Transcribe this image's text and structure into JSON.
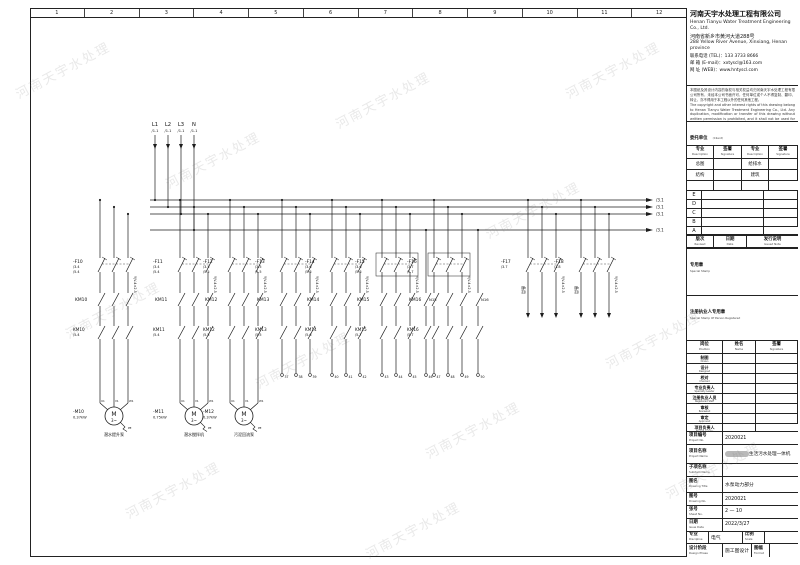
{
  "watermark": "河南天宇水处理",
  "ruler": {
    "numbers": [
      "1",
      "2",
      "3",
      "4",
      "5",
      "6",
      "7",
      "8",
      "9",
      "10",
      "11",
      "12"
    ]
  },
  "title_block": {
    "company": {
      "name_cn": "河南天宇水处理工程有限公司",
      "name_en": "Henan Tianyu Water Treatment Engineering Co., Ltd.",
      "address_cn": "河南省新乡市黄河大道288号",
      "address_en": "288 Yellow River Avenue, Xinxiang, Henan province",
      "tel_line": "联系电话 (TEL)：133 3733 8666",
      "email_line": "邮  箱 (E-mail)：xxtyscl@163.com",
      "web_line": "网  址 (WEB)：www.hntyscl.com"
    },
    "disclaimer_cn": "本图纸及其设计内容的版权与相关权益均归河南天宇水处理工程有限公司所有，未经本公司书面许可，任何单位或个人不得复制、翻印、转让，亦不得用于本工程以外的任何其他工程。",
    "disclaimer_en": "The copyright and other interest rights of this drawing belong to Henan Tianyu Water Treatment Engineering Co., Ltd. Any duplication, modification or transfer of this drawing without written permission is prohibited, and it shall not be used for any other project.",
    "client": {
      "label_cn": "委托单位",
      "label_en": "(Client)",
      "value_suffix": "有限公司"
    },
    "spec_table": {
      "headers": [
        {
          "cn": "专业",
          "en": "Description"
        },
        {
          "cn": "签署",
          "en": "Signature"
        },
        {
          "cn": "专业",
          "en": "Description"
        },
        {
          "cn": "签署",
          "en": "Signature"
        }
      ],
      "rows": [
        [
          "总图",
          "",
          "给排水",
          ""
        ],
        [
          "结构",
          "",
          "建筑",
          ""
        ],
        [
          "",
          "",
          "",
          ""
        ]
      ]
    },
    "revisions": {
      "letters": [
        "E",
        "D",
        "C",
        "B",
        "A"
      ],
      "header": [
        {
          "cn": "版次",
          "en": "Revised"
        },
        {
          "cn": "日期",
          "en": "Date"
        },
        {
          "cn": "发行说明",
          "en": "Issued Note"
        }
      ]
    },
    "stamp1": {
      "cn": "专用章",
      "en": "Special Stamp"
    },
    "stamp2": {
      "cn": "注册执业人专用章",
      "en": "Special Stamp Of Person Registered"
    },
    "personnel": {
      "header": [
        {
          "cn": "岗位",
          "en": "Position"
        },
        {
          "cn": "姓名",
          "en": "Name"
        },
        {
          "cn": "签署",
          "en": "Signature"
        }
      ],
      "rows": [
        {
          "cn": "制图",
          "en": "Drawn"
        },
        {
          "cn": "设计",
          "en": "Designed"
        },
        {
          "cn": "校对",
          "en": "Checked"
        },
        {
          "cn": "专业负责人",
          "en": "Specialty Leader"
        },
        {
          "cn": "注册执业人员",
          "en": "Registered Staff"
        },
        {
          "cn": "审核",
          "en": "Reviewed"
        },
        {
          "cn": "审定",
          "en": "Approved"
        },
        {
          "cn": "项目负责人",
          "en": "Project Leader"
        }
      ]
    },
    "project_no": {
      "label_cn": "项目编号",
      "label_en": "Project No.",
      "value": "2020021"
    },
    "project_name": {
      "label_cn": "项目名称",
      "label_en": "Project Name",
      "value_suffix": "生活污水处理一体机"
    },
    "subitem": {
      "label_cn": "子项名称",
      "label_en": "Subitem Name",
      "value": ""
    },
    "drawing_title": {
      "label_cn": "图名",
      "label_en": "Drawing Title",
      "value": "水泵动力部分"
    },
    "drawing_no": {
      "label_cn": "图号",
      "label_en": "Drawing No.",
      "value": "2020021"
    },
    "sheet_no": {
      "label_cn": "张号",
      "label_en": "Sheet No.",
      "value": "2 — 10"
    },
    "issue_date": {
      "label_cn": "日期",
      "label_en": "Issue Date",
      "value": "2022/3/27"
    },
    "discipline": {
      "label_cn": "专业",
      "label_en": "Discipline",
      "value": "电气"
    },
    "scale": {
      "label_cn": "比例",
      "label_en": "Scale",
      "value": ""
    },
    "phase": {
      "label_cn": "设计阶段",
      "label_en": "Design Phase",
      "value": "施工图设计"
    },
    "format": {
      "label_cn": "图幅",
      "label_en": "Format",
      "value": ""
    }
  },
  "schematic": {
    "line_color": "#1c1c1c",
    "incoming": [
      {
        "label": "L1",
        "ref": "/1.1",
        "x": 125
      },
      {
        "label": "L2",
        "ref": "/1.1",
        "x": 138
      },
      {
        "label": "L3",
        "ref": "/1.1",
        "x": 151
      },
      {
        "label": "N",
        "ref": "/1.1",
        "x": 164
      }
    ],
    "buses": [
      {
        "y": 182,
        "ref": "/3.1"
      },
      {
        "y": 189,
        "ref": "/3.1"
      },
      {
        "y": 196,
        "ref": "/3.1"
      },
      {
        "y": 212,
        "ref": "/3.1"
      }
    ],
    "branches": [
      {
        "x": 70,
        "breaker": "-F10",
        "refs": [
          "/3.4",
          "/5.4"
        ],
        "contactor": "KM10",
        "contact2": "KM10",
        "contact2_ref": "/5.4",
        "cable": "YJV-4×2.5",
        "load": {
          "type": "motor",
          "tag": "-M10",
          "power": "0.37kW",
          "name": "潜水提升泵",
          "terminals": [
            "U1",
            "V1",
            "W1"
          ]
        }
      },
      {
        "x": 150,
        "breaker": "-F11",
        "refs": [
          "/3.4",
          "/5.4"
        ],
        "contactor": "KM11",
        "contact2": "KM11",
        "contact2_ref": "/5.4",
        "cable": "YJV-4×2.5",
        "load": {
          "type": "motor",
          "tag": "-M11",
          "power": "0.75kW",
          "name": "潜水搅拌机",
          "terminals": [
            "U1",
            "V1",
            "W1"
          ]
        }
      },
      {
        "x": 200,
        "breaker": "-F12",
        "refs": [
          "/3.5",
          "/5.5"
        ],
        "contactor": "KM12",
        "contact2": "KM12",
        "contact2_ref": "/5.5",
        "cable": "YJV-4×2.5",
        "load": {
          "type": "motor",
          "tag": "-M12",
          "power": "0.37kW",
          "name": "污泥回流泵",
          "terminals": [
            "U1",
            "V1",
            "W1"
          ]
        }
      },
      {
        "x": 252,
        "breaker": "-F13",
        "refs": [
          "/3.5",
          "/5.5"
        ],
        "contactor": "KM13",
        "contact2": "KM13",
        "contact2_ref": "/5.5",
        "cable": "YJV-4×2.5",
        "load": {
          "type": "terminal",
          "numbers": [
            "37",
            "38",
            "39"
          ]
        }
      },
      {
        "x": 302,
        "breaker": "-F14",
        "refs": [
          "/3.6",
          "/5.6"
        ],
        "contactor": "KM14",
        "contact2": "KM14",
        "contact2_ref": "/5.6",
        "cable": "YJV-4×2.5",
        "load": {
          "type": "terminal",
          "numbers": [
            "40",
            "41",
            "42"
          ]
        }
      },
      {
        "x": 352,
        "breaker": "-F15",
        "refs": [
          "/3.6",
          "/5.6"
        ],
        "boxed": true,
        "contactor": "KM15",
        "aux": "N15",
        "contact2": "KM15",
        "contact2_ref": "/5.7",
        "cable": "YJV-4×2.5",
        "load": {
          "type": "terminal",
          "numbers": [
            "43",
            "44",
            "45"
          ],
          "aux_number": "46"
        }
      },
      {
        "x": 404,
        "breaker": "-F16",
        "refs": [
          "/3.7",
          "/5.7"
        ],
        "boxed": true,
        "contactor": "KM16",
        "aux": "N16",
        "contact2": "KM16",
        "contact2_ref": "/5.7",
        "cable": "YJV-4×2.5",
        "load": {
          "type": "terminal",
          "numbers": [
            "47",
            "48",
            "49"
          ],
          "aux_number": "50"
        }
      },
      {
        "x": 498,
        "breaker": "-F17",
        "refs": [
          "/3.7"
        ],
        "cable": "YJV-4×2.5",
        "load": {
          "type": "spare",
          "label": "备用"
        }
      },
      {
        "x": 551,
        "breaker": "-F18",
        "refs": [
          "/3.8"
        ],
        "cable": "YJV-4×2.5",
        "load": {
          "type": "spare",
          "label": "备用"
        }
      }
    ]
  }
}
